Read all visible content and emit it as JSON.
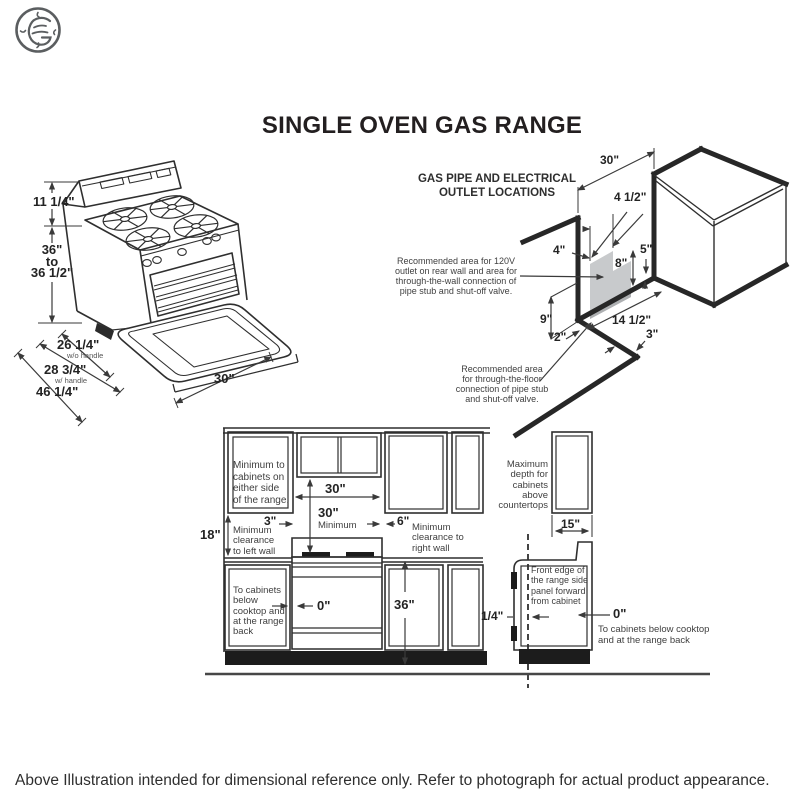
{
  "logo": {
    "label": "GE"
  },
  "title": "SINGLE OVEN GAS RANGE",
  "disclaimer": "Above Illustration intended for dimensional reference only. Refer to photograph for actual product appearance.",
  "range_iso": {
    "backguard_height": "11 1/4\"",
    "height_range": "36\"\nto\n36 1/2\"",
    "depth_wo_handle": "26 1/4\"",
    "depth_wo_handle_note": "w/o handle",
    "depth_w_handle": "28 3/4\"",
    "depth_w_handle_note": "w/ handle",
    "depth_overall": "46 1/4\"",
    "width": "30\""
  },
  "gas_diagram": {
    "heading": "GAS PIPE AND ELECTRICAL\nOUTLET LOCATIONS",
    "note_wall": "Recommended area for 120V\noutlet on rear wall and area for\nthrough-the-wall connection of\npipe stub and shut-off valve.",
    "note_floor": "Recommended area\nfor through-the-floor\nconnection of pipe stub\nand shut-off valve.",
    "dim_30": "30\"",
    "dim_4_5": "4 1/2\"",
    "dim_5": "5\"",
    "dim_4": "4\"",
    "dim_8": "8\"",
    "dim_9": "9\"",
    "dim_2": "2\"",
    "dim_14_5": "14 1/2\"",
    "dim_3": "3\""
  },
  "front_elevation": {
    "note_side_cabinets": "Minimum to\ncabinets on\neither side\nof the range.",
    "dim_30_top": "30\"",
    "dim_30_min": "30\"",
    "min_label": "Minimum",
    "dim_3": "3\"",
    "dim_6": "6\"",
    "dim_18": "18\"",
    "note_left_wall": "Minimum\nclearance\nto left wall",
    "note_right_wall": "Minimum\nclearance to\nright wall",
    "dim_0": "0\"",
    "dim_36": "36\"",
    "note_below_cabinets": "To cabinets\nbelow\ncooktop and\nat the range\nback"
  },
  "side_elevation": {
    "note_max_depth": "Maximum\ndepth for\ncabinets above\ncountertops",
    "dim_15": "15\"",
    "note_front_edge": "Front edge of\nthe range side\npanel forward\nfrom cabinet",
    "dim_quarter": "1/4\"",
    "dim_0": "0\"",
    "note_below_cabinets": "To cabinets below cooktop\nand at the range back"
  }
}
